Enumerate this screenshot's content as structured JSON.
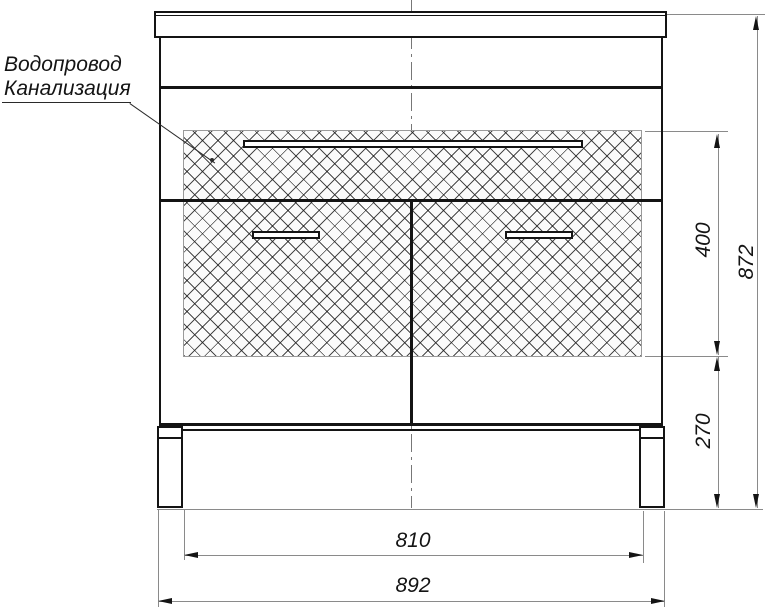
{
  "callout": {
    "line1": "Водопровод",
    "line2": "Канализация"
  },
  "dimensions": {
    "hatch_zone_height": "400",
    "lower_zone_height": "270",
    "overall_height": "872",
    "legs_inner_width": "810",
    "overall_width": "892"
  },
  "colors": {
    "object_line": "#141414",
    "dimension_line": "#8a8a8a",
    "hatch_border": "#9a9a9a",
    "background": "#ffffff"
  }
}
